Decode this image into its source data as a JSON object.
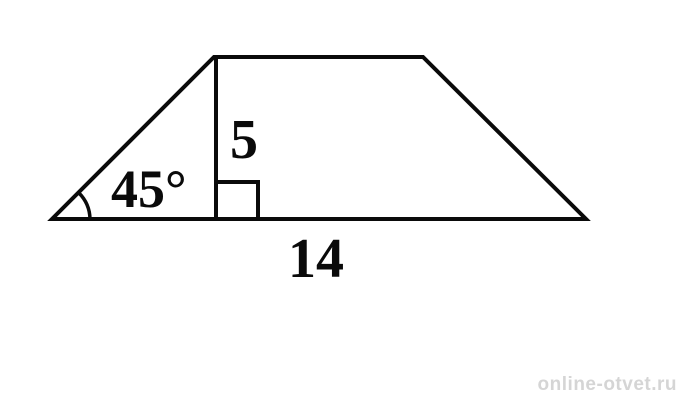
{
  "figure": {
    "type": "trapezoid-with-height",
    "angle_label": "45°",
    "height_label": "5",
    "base_label": "14"
  },
  "watermark": {
    "text": "online-otvet.ru"
  },
  "colors": {
    "line": "#0a0a0a",
    "watermark": "#d5d5d5",
    "background": "#ffffff"
  }
}
